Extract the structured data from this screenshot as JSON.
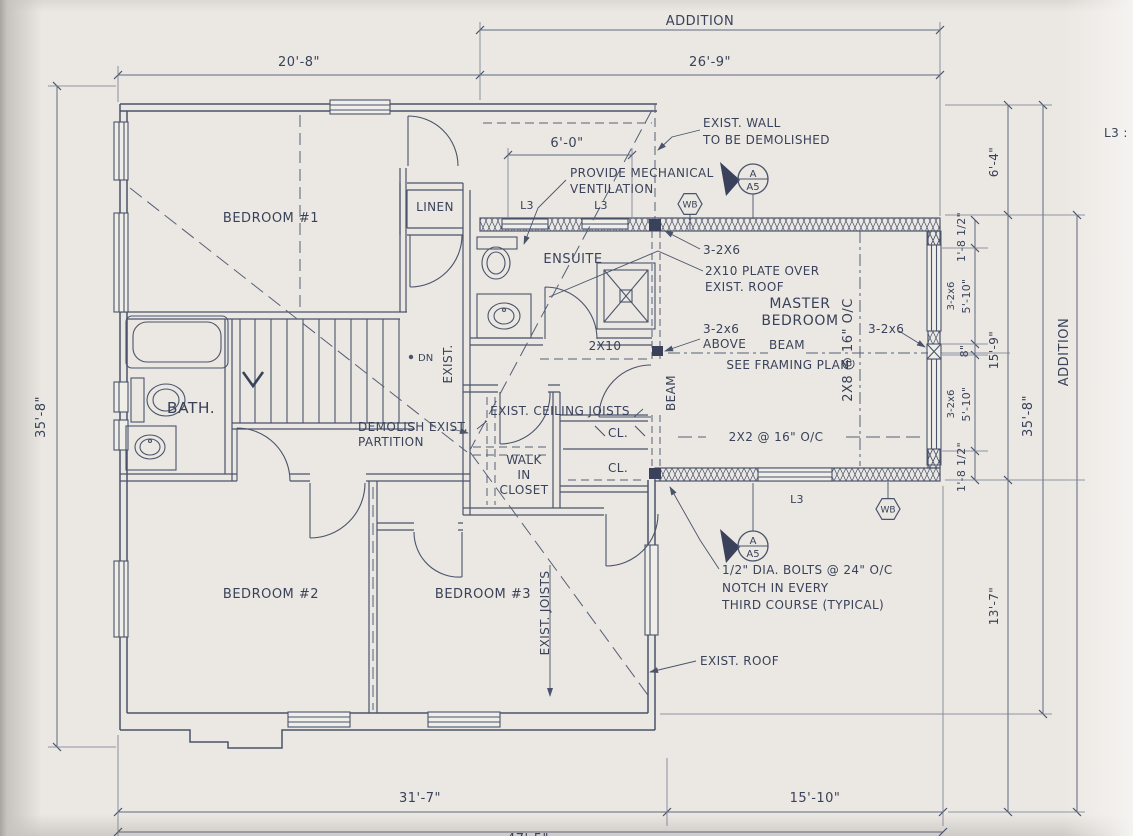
{
  "colors": {
    "paper": "#ebe8e3",
    "ink": "#49536a",
    "text": "#39425a"
  },
  "rooms": {
    "bedroom1": "BEDROOM #1",
    "linen": "LINEN",
    "ensuite": "ENSUITE",
    "bath": "BATH.",
    "master_line1": "MASTER",
    "master_line2": "BEDROOM",
    "wic_line1": "WALK",
    "wic_line2": "IN",
    "wic_line3": "CLOSET",
    "cl": "CL.",
    "bedroom2": "BEDROOM #2",
    "bedroom3": "BEDROOM #3"
  },
  "dims": {
    "addition_top": "ADDITION",
    "addition_right": "ADDITION",
    "w_existing": "20'-8\"",
    "w_addition": "26'-9\"",
    "w_ensuite": "6'-0\"",
    "h_left": "35'-8\"",
    "h_right": "35'-8\"",
    "h_top_right": "6'-4\"",
    "h_master": "15'-9\"",
    "h_lower_right": "13'-7\"",
    "seg_18": "1'-8 1/2\"",
    "seg_2x6": "3-2x6",
    "seg_510": "5'-10\"",
    "seg_8": "8\"",
    "w_bottom_left": "31'-7\"",
    "w_bottom_right": "15'-10\"",
    "w_total": "47'-5\""
  },
  "notes": {
    "exist_wall_1": "EXIST. WALL",
    "exist_wall_2": "TO BE DEMOLISHED",
    "mech_vent_1": "PROVIDE MECHANICAL",
    "mech_vent_2": "VENTILATION",
    "post_top": "3-2X6",
    "plate_1": "2X10 PLATE OVER",
    "plate_2": "EXIST. ROOF",
    "post_above_1": "3-2x6",
    "post_above_2": "ABOVE",
    "post_mid": "3-2x6",
    "joist_2x10": "2X10",
    "beam_v": "BEAM",
    "beam_h": "BEAM",
    "see_framing": "SEE FRAMING PLAN",
    "rafters": "2X8 @ 16\" O/C",
    "strapping": "2X2 @ 16\" O/C",
    "ceiling_joists": "EXIST. CEILING JOISTS",
    "demolish_1": "DEMOLISH EXIST.",
    "demolish_2": "PARTITION",
    "exist_v": "EXIST.",
    "exist_joists": "EXIST. JOISTS",
    "bolts_1": "1/2\" DIA. BOLTS @ 24\" O/C",
    "bolts_2": "NOTCH IN EVERY",
    "bolts_3": "THIRD COURSE (TYPICAL)",
    "exist_roof": "EXIST. ROOF",
    "dn": "DN",
    "legend_partial": "L3 : L"
  },
  "markers": {
    "l3": "L3",
    "wb": "WB",
    "section_a": "A",
    "section_a5": "A5"
  }
}
